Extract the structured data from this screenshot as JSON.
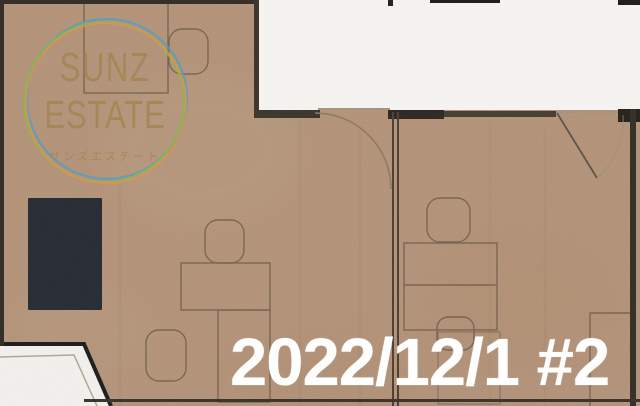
{
  "watermark": {
    "title_line1": "SUNZ",
    "title_line2": "ESTATE",
    "subtitle": "サンズエステート"
  },
  "caption": {
    "date_label": "2022/12/1 #2"
  },
  "colors": {
    "floor": "#b39379",
    "void_white": "#f6f5f2",
    "balcony_white": "#f2f1ed",
    "wall_dark": "#312a23",
    "cabinet": "#242a31",
    "furniture_line": "#6f5c49",
    "logo_text": "#a3854f",
    "ring_blue": "#4f9fc4",
    "ring_green": "#83bb4f",
    "ring_orange": "#e3924b",
    "caption_text": "#ffffff"
  }
}
